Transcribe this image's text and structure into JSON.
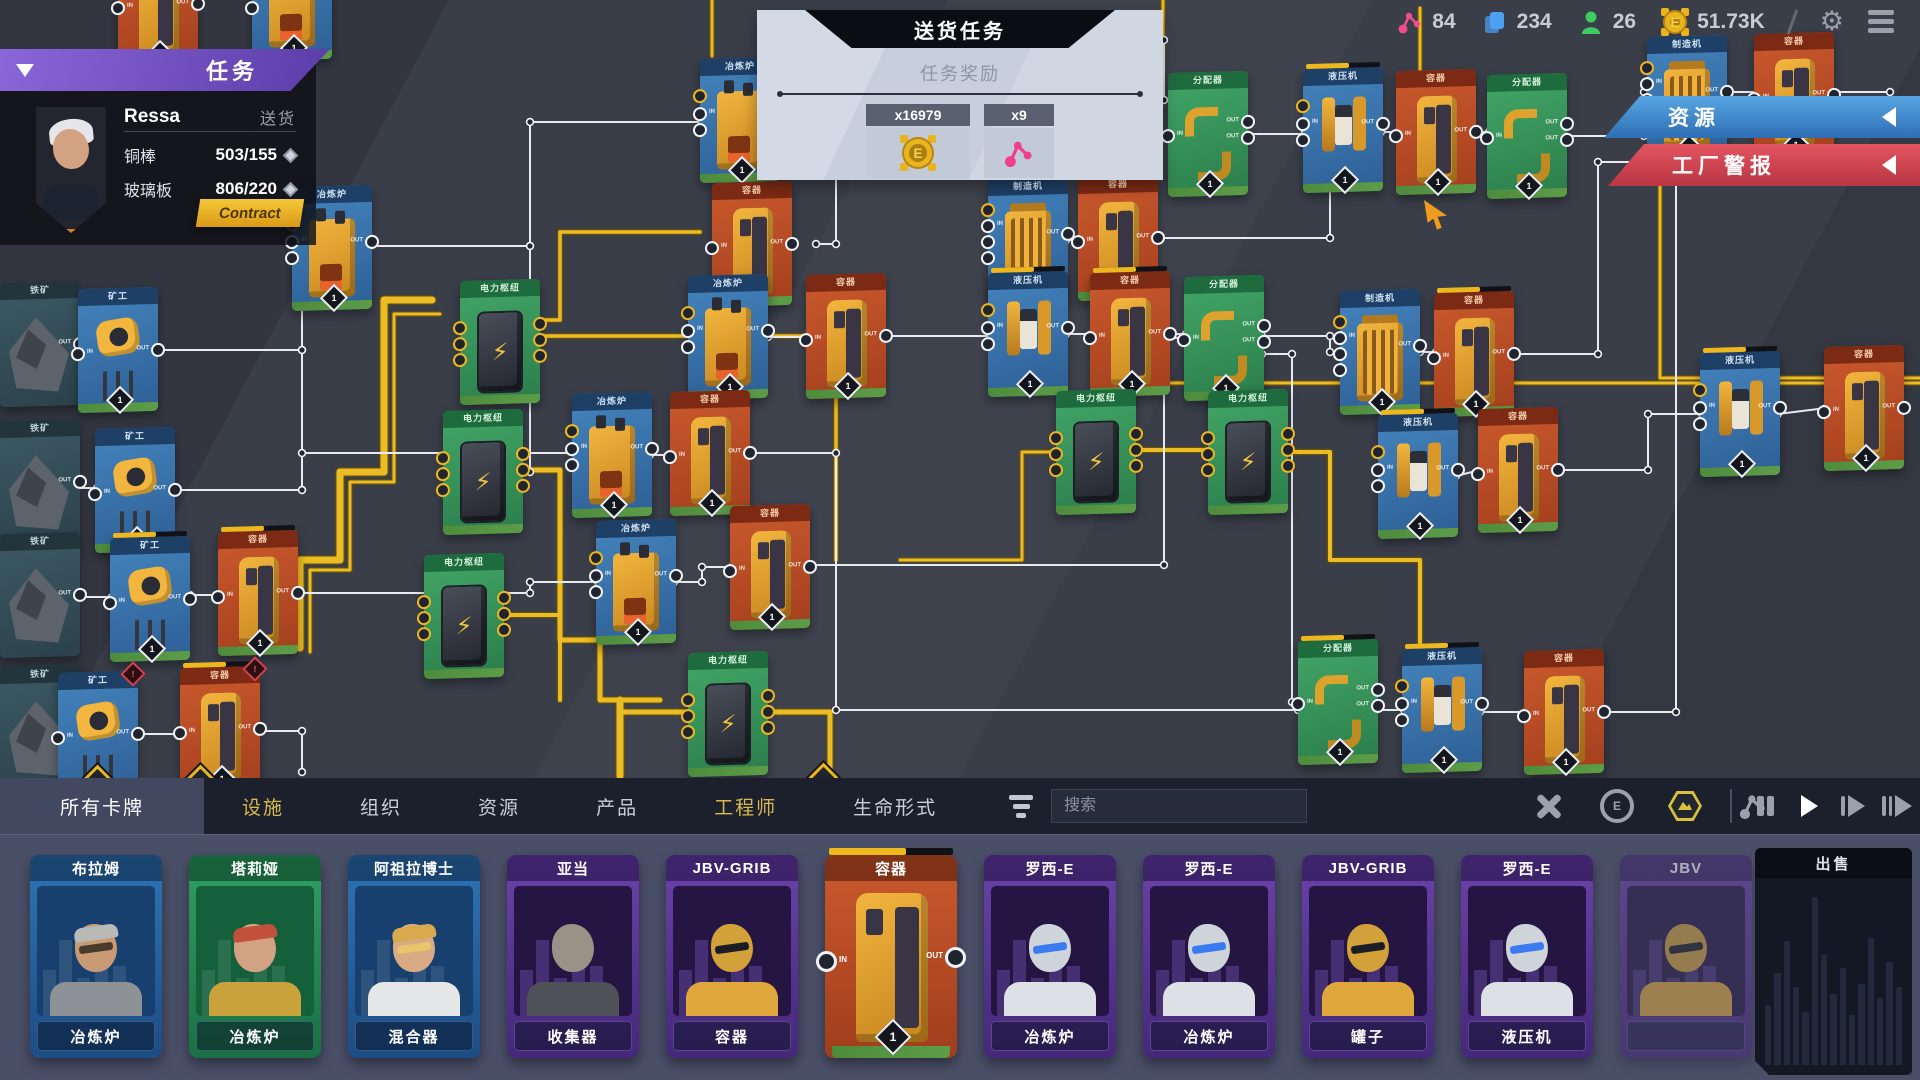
{
  "topbar": {
    "stats": [
      {
        "icon": "molecule-icon",
        "value": "84",
        "color": "#f24d8c"
      },
      {
        "icon": "cards-icon",
        "value": "234",
        "color": "#4da0f2"
      },
      {
        "icon": "engineer-icon",
        "value": "26",
        "color": "#3ecb5f"
      },
      {
        "icon": "coin-icon",
        "value": "51.73K",
        "color": "#eab41f"
      }
    ]
  },
  "quest_panel": {
    "title": "送货任务",
    "rewards_label": "任务奖励",
    "rewards": [
      {
        "qty": "x16979",
        "icon": "coin-icon"
      },
      {
        "qty": "x9",
        "icon": "molecule-icon"
      }
    ]
  },
  "task_panel": {
    "title": "任务",
    "agent_name": "Ressa",
    "task_type": "送货",
    "requirements": [
      {
        "item": "铜棒",
        "progress": "503/155"
      },
      {
        "item": "玻璃板",
        "progress": "806/220"
      }
    ],
    "contract_label": "Contract"
  },
  "side_banners": {
    "resources": "资源",
    "factory_alert": "工厂警报"
  },
  "toolbar": {
    "tabs": [
      {
        "label": "所有卡牌",
        "active": true,
        "accent": false
      },
      {
        "label": "设施",
        "active": false,
        "accent": true
      },
      {
        "label": "组织",
        "active": false,
        "accent": false
      },
      {
        "label": "资源",
        "active": false,
        "accent": false
      },
      {
        "label": "产品",
        "active": false,
        "accent": false
      },
      {
        "label": "工程师",
        "active": false,
        "accent": true
      },
      {
        "label": "生命形式",
        "active": false,
        "accent": false
      }
    ],
    "search_placeholder": "搜索",
    "tool_icons": [
      "repair-tools-icon",
      "automation-coin-icon",
      "hexagon-icon",
      "molecule-icon"
    ],
    "sim_controls": [
      "pause",
      "play",
      "fast-forward",
      "fastest"
    ]
  },
  "shelf": {
    "cards": [
      {
        "title": "布拉姆",
        "subtitle": "冶炼炉",
        "theme": "blue",
        "kind": "engineer",
        "look": "man-cap"
      },
      {
        "title": "塔莉娅",
        "subtitle": "冶炼炉",
        "theme": "green",
        "kind": "engineer",
        "look": "woman-red"
      },
      {
        "title": "阿祖拉博士",
        "subtitle": "混合器",
        "theme": "blue",
        "kind": "engineer",
        "look": "woman-blonde"
      },
      {
        "title": "亚当",
        "subtitle": "收集器",
        "theme": "purple",
        "kind": "engineer",
        "look": "android-gray"
      },
      {
        "title": "JBV-GRIB",
        "subtitle": "容器",
        "theme": "purple",
        "kind": "engineer",
        "look": "robot-gold"
      },
      {
        "title": "容器",
        "subtitle": "",
        "theme": "orange",
        "kind": "machine",
        "badge": "1",
        "in_label": "IN",
        "out_label": "OUT"
      },
      {
        "title": "罗西-E",
        "subtitle": "冶炼炉",
        "theme": "purple",
        "kind": "engineer",
        "look": "robot-silver"
      },
      {
        "title": "罗西-E",
        "subtitle": "冶炼炉",
        "theme": "purple",
        "kind": "engineer",
        "look": "robot-silver"
      },
      {
        "title": "JBV-GRIB",
        "subtitle": "罐子",
        "theme": "purple",
        "kind": "engineer",
        "look": "robot-gold"
      },
      {
        "title": "罗西-E",
        "subtitle": "液压机",
        "theme": "purple",
        "kind": "engineer",
        "look": "robot-silver"
      },
      {
        "title": "JBV",
        "subtitle": "",
        "theme": "purple",
        "kind": "engineer",
        "look": "robot-gold",
        "faded": true
      }
    ]
  },
  "sell_panel": {
    "title": "出售",
    "bars": [
      34,
      52,
      70,
      44,
      30,
      95,
      62,
      40,
      55,
      28,
      46,
      72,
      38,
      58,
      44
    ]
  },
  "factory": {
    "labels": {
      "power": "电力枢纽",
      "smelter": "冶炼炉",
      "container": "容器",
      "maker": "制造机",
      "press": "液压机",
      "distributor": "分配器",
      "miner": "矿工",
      "ore": "铁矿"
    },
    "badge": "1",
    "warn": "!",
    "port_labels": {
      "in": "IN",
      "out": "OUT"
    },
    "nodes": [
      {
        "x": 118,
        "y": -58,
        "t": "container"
      },
      {
        "x": 252,
        "y": -64,
        "t": "smelter"
      },
      {
        "x": 0,
        "y": 282,
        "t": "ore"
      },
      {
        "x": 78,
        "y": 288,
        "t": "miner"
      },
      {
        "x": 0,
        "y": 420,
        "t": "ore"
      },
      {
        "x": 95,
        "y": 428,
        "t": "miner"
      },
      {
        "x": 0,
        "y": 533,
        "t": "ore"
      },
      {
        "x": 110,
        "y": 537,
        "t": "miner",
        "pr": true
      },
      {
        "x": 218,
        "y": 531,
        "t": "container",
        "pr": true
      },
      {
        "x": 0,
        "y": 666,
        "t": "ore"
      },
      {
        "x": 58,
        "y": 672,
        "t": "miner",
        "warn": true
      },
      {
        "x": 180,
        "y": 667,
        "t": "container",
        "warn": true,
        "pr": true
      },
      {
        "x": 292,
        "y": 186,
        "t": "smelter"
      },
      {
        "x": 700,
        "y": 58,
        "t": "smelter"
      },
      {
        "x": 712,
        "y": 182,
        "t": "container"
      },
      {
        "x": 460,
        "y": 280,
        "t": "power"
      },
      {
        "x": 443,
        "y": 410,
        "t": "power"
      },
      {
        "x": 424,
        "y": 554,
        "t": "power"
      },
      {
        "x": 688,
        "y": 652,
        "t": "power"
      },
      {
        "x": 688,
        "y": 275,
        "t": "smelter"
      },
      {
        "x": 806,
        "y": 274,
        "t": "container"
      },
      {
        "x": 572,
        "y": 393,
        "t": "smelter"
      },
      {
        "x": 670,
        "y": 391,
        "t": "container"
      },
      {
        "x": 596,
        "y": 520,
        "t": "smelter"
      },
      {
        "x": 730,
        "y": 505,
        "t": "container"
      },
      {
        "x": 988,
        "y": 178,
        "t": "maker",
        "pr": true
      },
      {
        "x": 1078,
        "y": 176,
        "t": "container"
      },
      {
        "x": 988,
        "y": 272,
        "t": "press",
        "pr": true
      },
      {
        "x": 1090,
        "y": 272,
        "t": "container",
        "pr": true
      },
      {
        "x": 1184,
        "y": 276,
        "t": "distributor"
      },
      {
        "x": 1340,
        "y": 290,
        "t": "maker"
      },
      {
        "x": 1434,
        "y": 292,
        "t": "container",
        "pr": true
      },
      {
        "x": 1378,
        "y": 414,
        "t": "press",
        "pr": true
      },
      {
        "x": 1478,
        "y": 408,
        "t": "container"
      },
      {
        "x": 1168,
        "y": 72,
        "t": "distributor"
      },
      {
        "x": 1303,
        "y": 68,
        "t": "press",
        "pr": true
      },
      {
        "x": 1396,
        "y": 70,
        "t": "container"
      },
      {
        "x": 1487,
        "y": 74,
        "t": "distributor"
      },
      {
        "x": 1056,
        "y": 390,
        "t": "power"
      },
      {
        "x": 1208,
        "y": 390,
        "t": "power"
      },
      {
        "x": 1647,
        "y": 36,
        "t": "maker"
      },
      {
        "x": 1754,
        "y": 33,
        "t": "container"
      },
      {
        "x": 1700,
        "y": 352,
        "t": "press",
        "pr": true
      },
      {
        "x": 1824,
        "y": 346,
        "t": "container"
      },
      {
        "x": 1298,
        "y": 640,
        "t": "distributor",
        "pr": true
      },
      {
        "x": 1402,
        "y": 648,
        "t": "press",
        "pr": true
      },
      {
        "x": 1524,
        "y": 650,
        "t": "container"
      }
    ],
    "item_lines": [
      "40,346 80,346",
      "158,350 302,350 302,248 296,248",
      "40,488 97,488",
      "173,490 302,490 302,453 574,453",
      "302,350 302,490",
      "40,597 112,597",
      "190,595 220,595",
      "296,593 530,593 530,582 598,582",
      "40,730 60,730",
      "136,734 182,734",
      "258,731 302,731 302,772",
      "370,246 530,246 530,122 702,122",
      "530,246 530,472",
      "780,120 836,120 836,244 816,244",
      "836,120 836,40",
      "768,337 808,337",
      "886,336 1022,336 1022,240 990,240",
      "650,455 672,455",
      "748,453 836,453 836,710 1298,710 1298,702",
      "674,582 702,582 702,567 732,567",
      "808,565 1164,565 1164,338 1186,338",
      "1164,100 1164,40",
      "1066,240 1080,240",
      "1156,238 1330,238 1330,132 1305,132",
      "1066,334 1092,334",
      "1168,334 1186,334",
      "1262,336 1330,336 1330,352 1342,352",
      "1262,354 1292,354 1292,702 1300,702",
      "1420,352 1436,352",
      "1514,354 1598,354 1598,162 1680,162 1680,98 1702,98",
      "1456,476 1480,470",
      "1556,470 1648,470 1648,414 1702,414",
      "1778,414 1826,408",
      "1246,134 1305,134",
      "1381,132 1398,132",
      "1474,132 1489,132",
      "1565,136 1644,136 1644,92 1890,92",
      "1376,710 1404,710",
      "1480,712 1526,712",
      "1602,712 1676,712 1676,162"
    ],
    "power_lines": [
      {
        "pts": "432,300 384,300 384,472 340,472 340,560 300,560 300,648",
        "w": 7
      },
      {
        "pts": "440,314 394,314 394,482 350,482 350,570 310,570 310,652",
        "w": 3
      },
      {
        "pts": "540,320 560,320 560,232 700,232",
        "w": 3.5
      },
      {
        "pts": "540,336 836,336 836,560",
        "w": 3.5
      },
      {
        "pts": "520,470 560,470 560,640 600,640 600,700 660,700",
        "w": 5
      },
      {
        "pts": "500,615 560,615 560,700",
        "w": 4
      },
      {
        "pts": "620,700 620,776",
        "w": 7
      },
      {
        "pts": "688,712 620,712",
        "w": 5
      },
      {
        "pts": "768,712 830,712 830,772",
        "w": 5
      },
      {
        "pts": "1136,450 1210,450",
        "w": 4
      },
      {
        "pts": "1288,452 1330,452 1330,560 1420,560 1420,648",
        "w": 4
      },
      {
        "pts": "1058,452 1022,452 1022,560 900,560",
        "w": 3
      },
      {
        "pts": "712,0 712,56",
        "w": 3
      },
      {
        "pts": "1163,0 1163,60",
        "w": 3
      },
      {
        "pts": "1420,8 1420,130",
        "w": 3
      },
      {
        "pts": "1100,383 1920,383",
        "w": 3
      },
      {
        "pts": "1660,100 1660,378 1920,378",
        "w": 3
      }
    ],
    "diamond_markers": [
      [
        95,
        777
      ],
      [
        198,
        777
      ],
      [
        821,
        775
      ]
    ],
    "cursor": {
      "x": 1424,
      "y": 200
    }
  }
}
